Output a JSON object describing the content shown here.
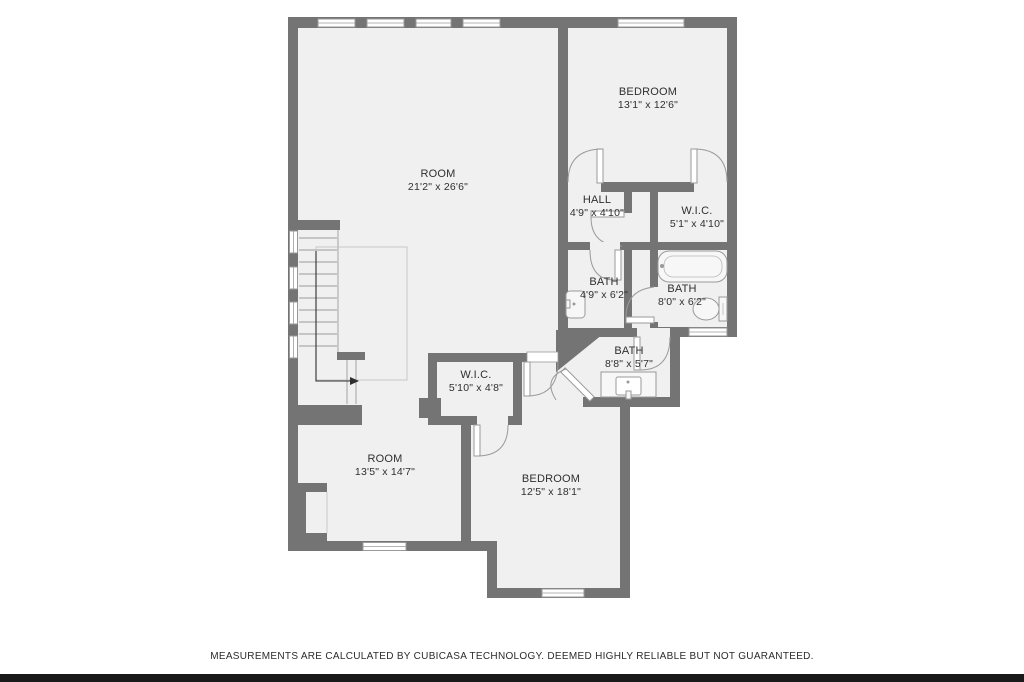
{
  "colors": {
    "wall": "#747474",
    "floor": "#f0f0f0",
    "line": "#9a9a9a",
    "arrow": "#2f2f2f",
    "text": "#2f2f2f",
    "footer_bar": "#1a1a1a"
  },
  "rooms": [
    {
      "id": "room-top",
      "name": "ROOM",
      "dims": "21'2\" x 26'6\""
    },
    {
      "id": "bedroom-top",
      "name": "BEDROOM",
      "dims": "13'1\" x 12'6\""
    },
    {
      "id": "hall",
      "name": "HALL",
      "dims": "4'9\" x 4'10\""
    },
    {
      "id": "wic-small",
      "name": "W.I.C.",
      "dims": "5'1\" x 4'10\""
    },
    {
      "id": "bath-left",
      "name": "BATH",
      "dims": "4'9\" x 6'2\""
    },
    {
      "id": "bath-right",
      "name": "BATH",
      "dims": "8'0\" x 6'2\""
    },
    {
      "id": "bath-diagonal",
      "name": "BATH",
      "dims": "8'8\" x 5'7\""
    },
    {
      "id": "wic-center",
      "name": "W.I.C.",
      "dims": "5'10\" x 4'8\""
    },
    {
      "id": "room-bottom",
      "name": "ROOM",
      "dims": "13'5\" x 14'7\""
    },
    {
      "id": "bedroom-bottom",
      "name": "BEDROOM",
      "dims": "12'5\" x 18'1\""
    }
  ],
  "fixtures": [
    "bathtub",
    "toilet",
    "sink",
    "vanity-sink",
    "staircase"
  ],
  "footer": {
    "disclaimer": "MEASUREMENTS ARE CALCULATED BY CUBICASA TECHNOLOGY. DEEMED HIGHLY RELIABLE BUT NOT GUARANTEED."
  }
}
